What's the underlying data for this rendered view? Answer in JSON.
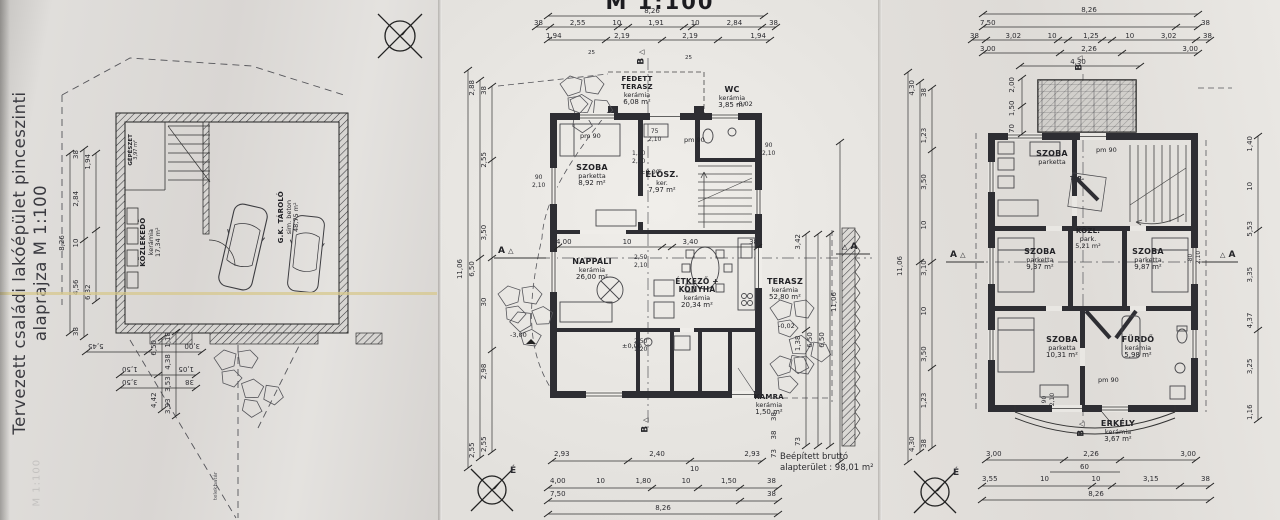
{
  "scan": {
    "north_letter": "É",
    "section_a": "A",
    "section_b": "B",
    "triangle": "△",
    "ink_color": "#2e2e33",
    "paper_color": "#e8e6e2"
  },
  "basement": {
    "title_line1": "Tervezett családi lakóépület",
    "title_line2": "pinceszinti alaprajza M 1:100",
    "bleed_text": "M 1:100",
    "boundary_label": "telekhatár",
    "rooms": {
      "gepeszet": {
        "name": "GÉPÉSZET",
        "area": "3,97 m²"
      },
      "kozlekedo": {
        "name": "KÖZLEKEDŐ",
        "finish": "kerámia",
        "area": "17,34 m²"
      },
      "garazs": {
        "name": "G.K. TÁROLÓ",
        "finish": "sim. beton",
        "area": "48,75 m²"
      }
    },
    "dims": {
      "total": "8,26",
      "chain_a": [
        "38",
        "4,56",
        "10",
        "2,84",
        "38"
      ],
      "chain_b": [
        "6,32",
        "1,94"
      ],
      "bottom_a": [
        "3,00",
        "5,45"
      ],
      "bottom_b1": [
        "1,05",
        "1,50"
      ],
      "bottom_b2": [
        "38",
        "3,50"
      ],
      "side_a": [
        "4,42",
        "6,50"
      ],
      "side_b": [
        "3,93",
        "3,53",
        "4,38",
        "1,18"
      ]
    }
  },
  "ground": {
    "title": "M 1:100",
    "note_line1": "Beépített bruttó",
    "note_line2": "alapterület : 98,01 m²",
    "pm90": "pm 90",
    "small_mark": "25",
    "levels": {
      "zero": "±0,00",
      "minus02": "-0,02",
      "minus300": "-3,00"
    },
    "rooms": {
      "fedett_terasz": {
        "name": "FEDETT TERASZ",
        "finish": "kerámia",
        "area": "6,08 m²"
      },
      "wc": {
        "name": "WC",
        "finish": "kerámia",
        "area": "3,85 m²"
      },
      "szoba": {
        "name": "SZOBA",
        "finish": "parketta",
        "area": "8,92 m²"
      },
      "elosz": {
        "name": "ELŐSZ.",
        "finish": "ker.",
        "area": "7,97 m²"
      },
      "nappali": {
        "name": "NAPPALI",
        "finish": "kerámia",
        "area": "26,00 m²"
      },
      "etkezo": {
        "name": "ÉTKEZŐ + KONYHA",
        "finish": "kerámia",
        "area": "20,34 m²"
      },
      "terasz": {
        "name": "TERASZ",
        "finish": "kerámia",
        "area": "52,80 m²"
      },
      "kamra": {
        "name": "KAMRA",
        "finish": "kerámia",
        "area": "1,50 m²"
      }
    },
    "pairs": {
      "p1": [
        "75",
        "2,10"
      ],
      "p2": [
        "1,00",
        "2,10"
      ],
      "p3": [
        "90",
        "2,10"
      ],
      "p4": [
        "2,50",
        "2,10"
      ],
      "p5": [
        "2,50",
        "1,20"
      ],
      "p6": [
        "90",
        "2,10"
      ]
    },
    "dims": {
      "top_total": "8,26",
      "top_chain": [
        "38",
        "2,55",
        "10",
        "1,91",
        "10",
        "2,84",
        "38"
      ],
      "top_chain2": [
        "1,94",
        "2,19",
        "2,19",
        "1,94"
      ],
      "inner_chain": [
        "4,00",
        "10",
        "3,40",
        "38"
      ],
      "left_total": "11,06",
      "left_mid": [
        "2,55",
        "6,50",
        "2,88"
      ],
      "left_chain": [
        "2,55",
        "2,98",
        "30",
        "3,50",
        "2,55",
        "38"
      ],
      "right_total": "11,06",
      "right_mid": [
        "6,50"
      ],
      "right_mid2": [
        "6,50"
      ],
      "right_chain": [
        "73",
        "1,38",
        "3,42"
      ],
      "right_small": [
        "73",
        "38",
        "38"
      ],
      "bottom_chain1": [
        "2,93",
        "2,40",
        "2,93"
      ],
      "bottom_small": "10",
      "bottom_chain2": [
        "4,00",
        "10",
        "1,80",
        "10",
        "1,50",
        "38"
      ],
      "bottom_chain3": [
        "7,50",
        "38"
      ],
      "bottom_total": "8,26"
    }
  },
  "upper": {
    "pm90": "pm 90",
    "rooms": {
      "szoba_t": {
        "name": "SZOBA",
        "finish": "parketta"
      },
      "tar": {
        "name": "TÁR."
      },
      "kozl": {
        "name": "KÖZL.",
        "finish": "park.",
        "area": "5,21 m²"
      },
      "szoba_l": {
        "name": "SZOBA",
        "finish": "parketta",
        "area": "9,37 m²"
      },
      "szoba_r": {
        "name": "SZOBA",
        "finish": "parketta",
        "area": "9,87 m²"
      },
      "szoba_b": {
        "name": "SZOBA",
        "finish": "parketta",
        "area": "10,31 m²"
      },
      "furdo": {
        "name": "FÜRDŐ",
        "finish": "kerámia",
        "area": "5,98 m²"
      },
      "erkely": {
        "name": "ERKÉLY",
        "finish": "kerámia",
        "area": "3,67 m²"
      }
    },
    "pairs": {
      "p1": [
        "90",
        "2,10"
      ],
      "p2": [
        "80",
        "2,10"
      ]
    },
    "dims": {
      "top_total": "8,26",
      "top_chain1": [
        "7,50",
        "38"
      ],
      "top_chain2": [
        "38",
        "3,02",
        "10",
        "1,25",
        "10",
        "3,02",
        "38"
      ],
      "top_chain3": [
        "3,00",
        "2,26",
        "3,00"
      ],
      "top_430": "4,30",
      "left_total": "11,06",
      "left_mid": [
        "4,30",
        "4,30"
      ],
      "left_chain": [
        "38",
        "1,23",
        "3,50",
        "10",
        "3,10",
        "10",
        "3,50",
        "1,23",
        "38"
      ],
      "left_small": [
        "70",
        "1,50",
        "2,00"
      ],
      "right_chain": [
        "1,16",
        "3,25",
        "4,37",
        "3,35",
        "5,53",
        "10",
        "1,40"
      ],
      "bottom_chain1": [
        "3,00",
        "2,26",
        "3,00"
      ],
      "bottom_small": "60",
      "bottom_chain2": [
        "3,55",
        "10",
        "10",
        "3,15",
        "38"
      ],
      "bottom_total": "8,26"
    }
  }
}
